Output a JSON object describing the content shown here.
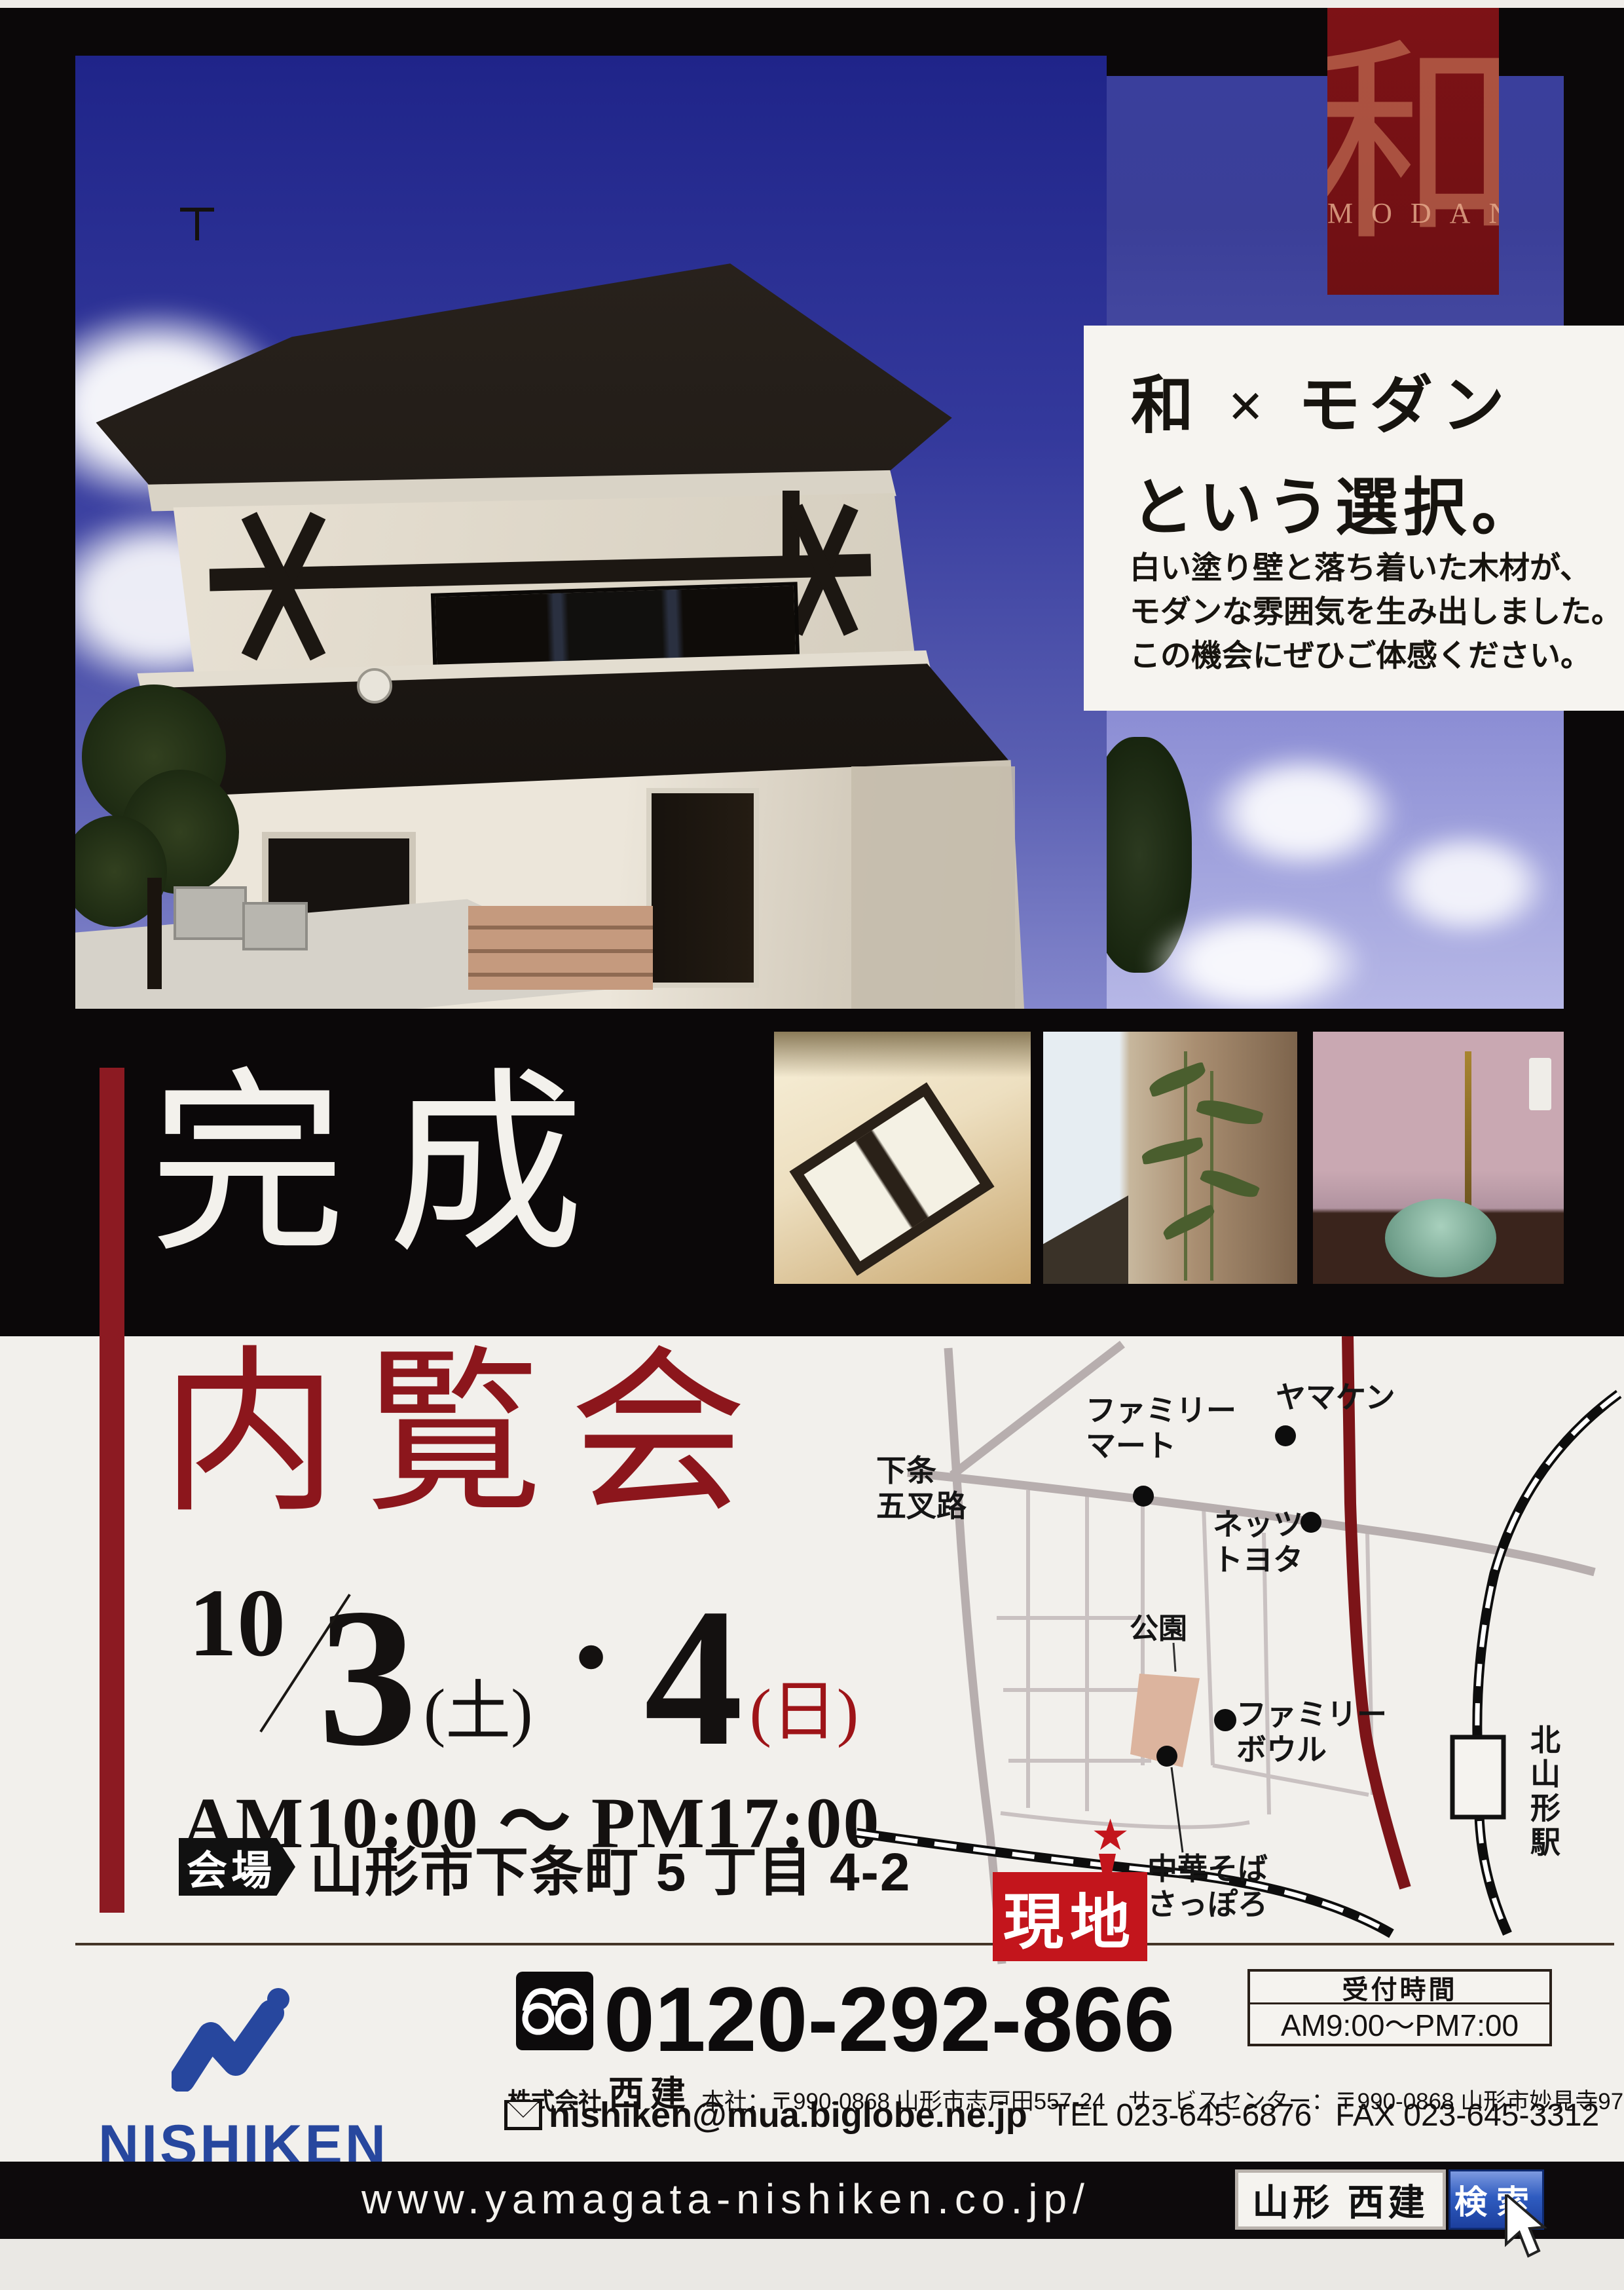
{
  "badge": {
    "kanji": "和",
    "label": "MODAN"
  },
  "hero": {
    "title_line1": "和 × モダン",
    "title_line2": "という選択。",
    "desc_line1": "白い塗り壁と落ち着いた木材が、",
    "desc_line2": "モダンな雰囲気を生み出しました。",
    "desc_line3": "この機会にぜひご体感ください。"
  },
  "event": {
    "kansei": "完成",
    "nairankai": "内覧会",
    "month": "10",
    "day1": "3",
    "day1_dow": "(土)",
    "separator": "・",
    "day2": "4",
    "day2_dow": "(日)",
    "time": "AM10:00 ～ PM17:00",
    "venue_label": "会場",
    "venue_address": "山形市下条町 5 丁目 4-2"
  },
  "map": {
    "kajo_line1": "下条",
    "kajo_line2": "五叉路",
    "famima_line1": "ファミリー",
    "famima_line2": "マート",
    "yamaken": "ヤマケン",
    "netz_line1": "ネッツ",
    "netz_line2": "トヨタ",
    "park": "公園",
    "bowl_line1": "ファミリー",
    "bowl_line2": "ボウル",
    "chuka_line1": "中華そば",
    "chuka_line2": "さっぽろ",
    "genchi": "現地",
    "station": "北山形駅",
    "star": "★"
  },
  "contact": {
    "phone": "0120-292-866",
    "company_prefix": "株式会社",
    "company_name": "西建",
    "company_rest": "本社：〒990-0868 山形市志戸田557-24　サービスセンター：〒990-0868 山形市妙見寺97-1",
    "email": "nishiken@mua.biglobe.ne.jp",
    "tel": "TEL 023-645-6876",
    "fax": "FAX 023-645-3312",
    "hours_label": "受付時間",
    "hours_value": "AM9:00～PM7:00",
    "logo_text": "NISHIKEN"
  },
  "footer": {
    "url": "www.yamagata-nishiken.co.jp/",
    "search_query": "山形 西建",
    "search_button": "検索"
  }
}
